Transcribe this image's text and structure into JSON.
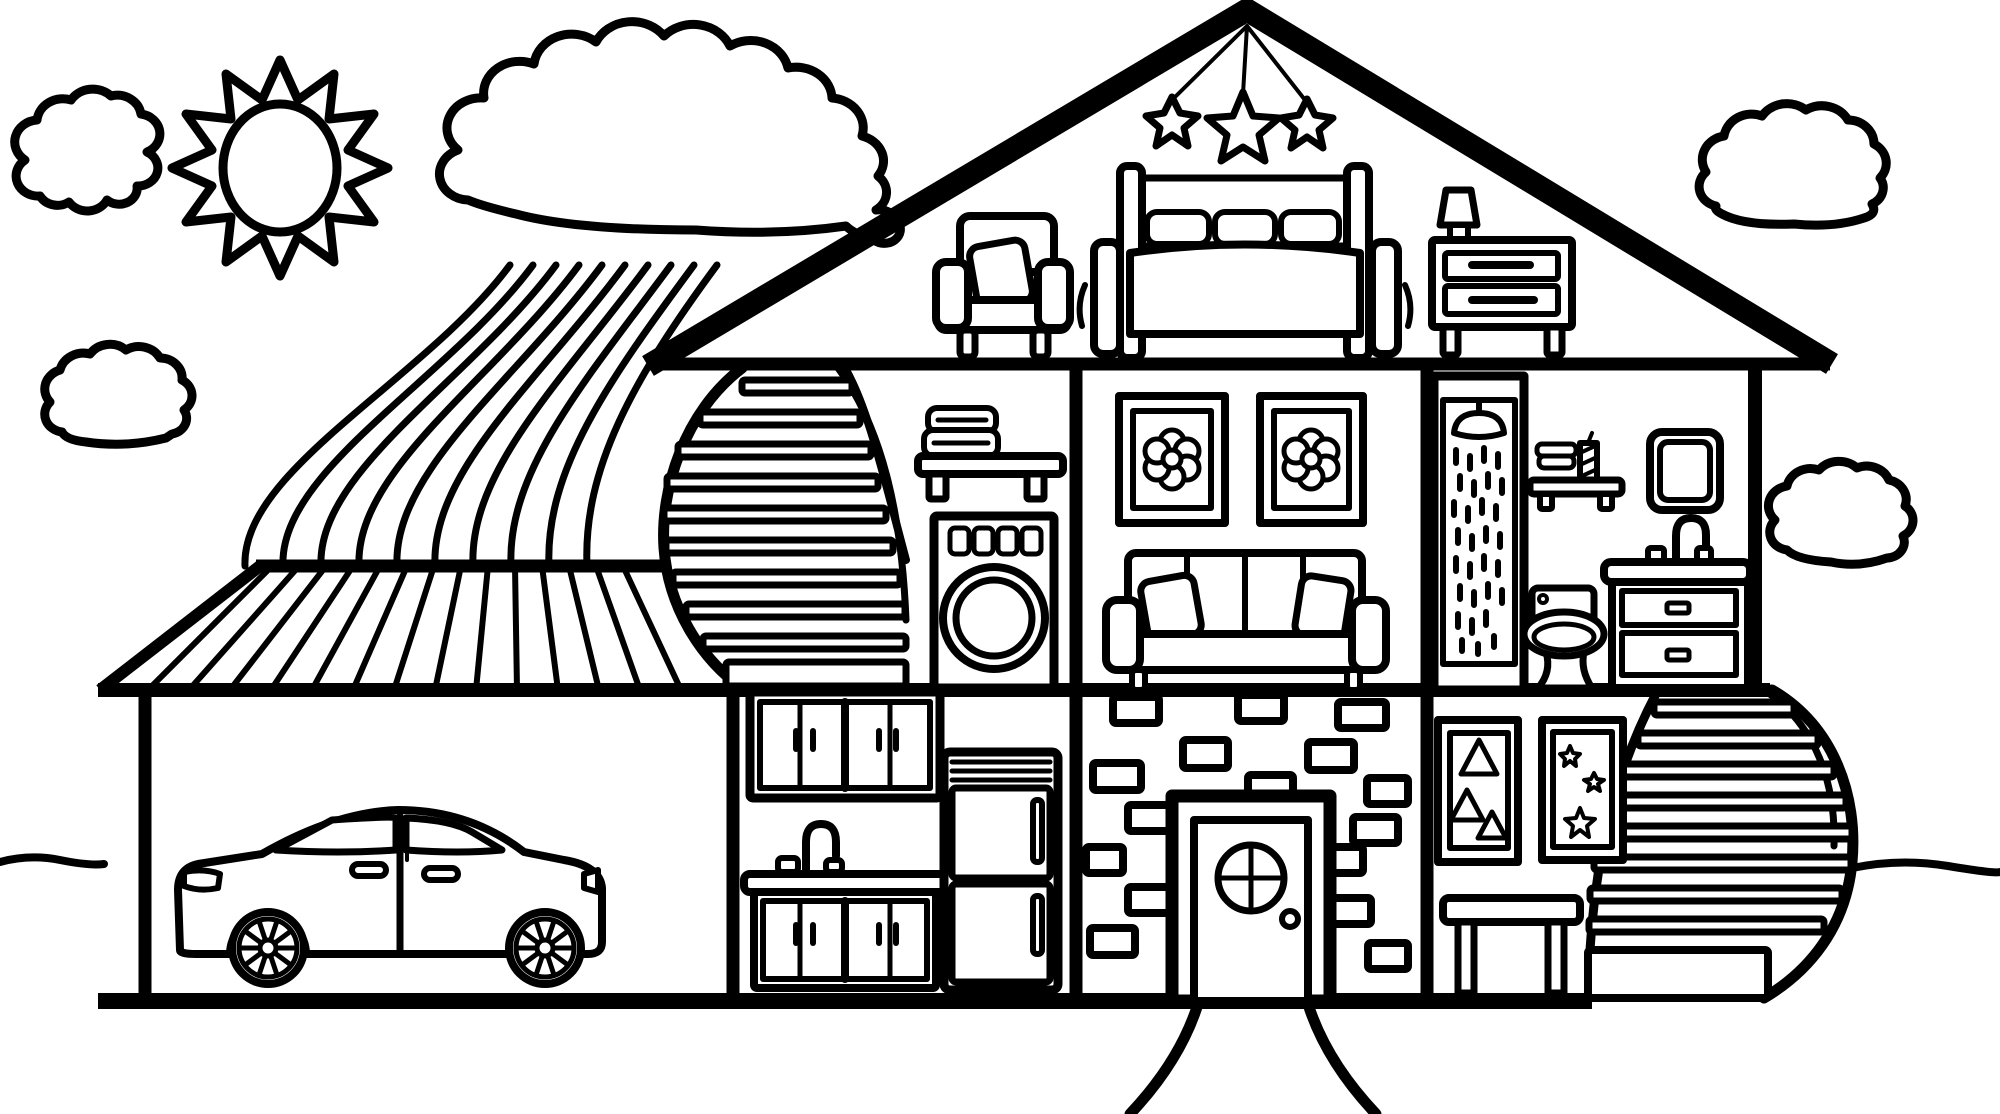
{
  "meta": {
    "kind": "coloring-book-line-drawing",
    "subject": "cutaway dollhouse cross-section with yard",
    "palette": {
      "line": "#000000",
      "background": "#ffffff"
    }
  },
  "sky": {
    "icons": [
      "sun-icon",
      "cloud-icon-small-left",
      "cloud-icon-large",
      "cloud-icon-mid-left",
      "cloud-icon-top-right",
      "cloud-icon-mid-right"
    ],
    "rainbow_bands": 10
  },
  "house": {
    "attic_bedroom": {
      "items": [
        "hanging-stars-mobile (3 stars)",
        "armchair with pillow",
        "double bed with 3 pillows and posts",
        "nightstand with 2 drawers",
        "table lamp"
      ]
    },
    "middle_floor": {
      "laundry_room": {
        "items": [
          "curved staircase",
          "wall shelf with towels",
          "front-load washing machine (4 buttons, round door)"
        ]
      },
      "living_room": {
        "items": [
          "framed flower picture",
          "framed flower picture",
          "three-seat sofa with 2 pillows"
        ]
      },
      "bathroom": {
        "items": [
          "shower stall with shower head and water",
          "wall shelf with towels and candle",
          "mirror",
          "vanity sink with faucet and 2 drawers",
          "toilet"
        ]
      }
    },
    "ground_floor": {
      "garage": {
        "items": [
          "sedan car side view, facing left"
        ]
      },
      "kitchen": {
        "items": [
          "upper cabinets (4 doors)",
          "sink with gooseneck faucet",
          "lower cabinets (4 doors)",
          "refrigerator (2 doors, vents)"
        ]
      },
      "entry": {
        "items": [
          "brick wall (16 bricks)",
          "front door with round window and knob",
          "walkway lines below door"
        ]
      },
      "play_room": {
        "items": [
          "framed picture with 3 triangles",
          "framed picture with 3 stars",
          "side table",
          "curved staircase to outside"
        ]
      }
    }
  },
  "ground": {
    "left_line": true,
    "right_line": true
  }
}
